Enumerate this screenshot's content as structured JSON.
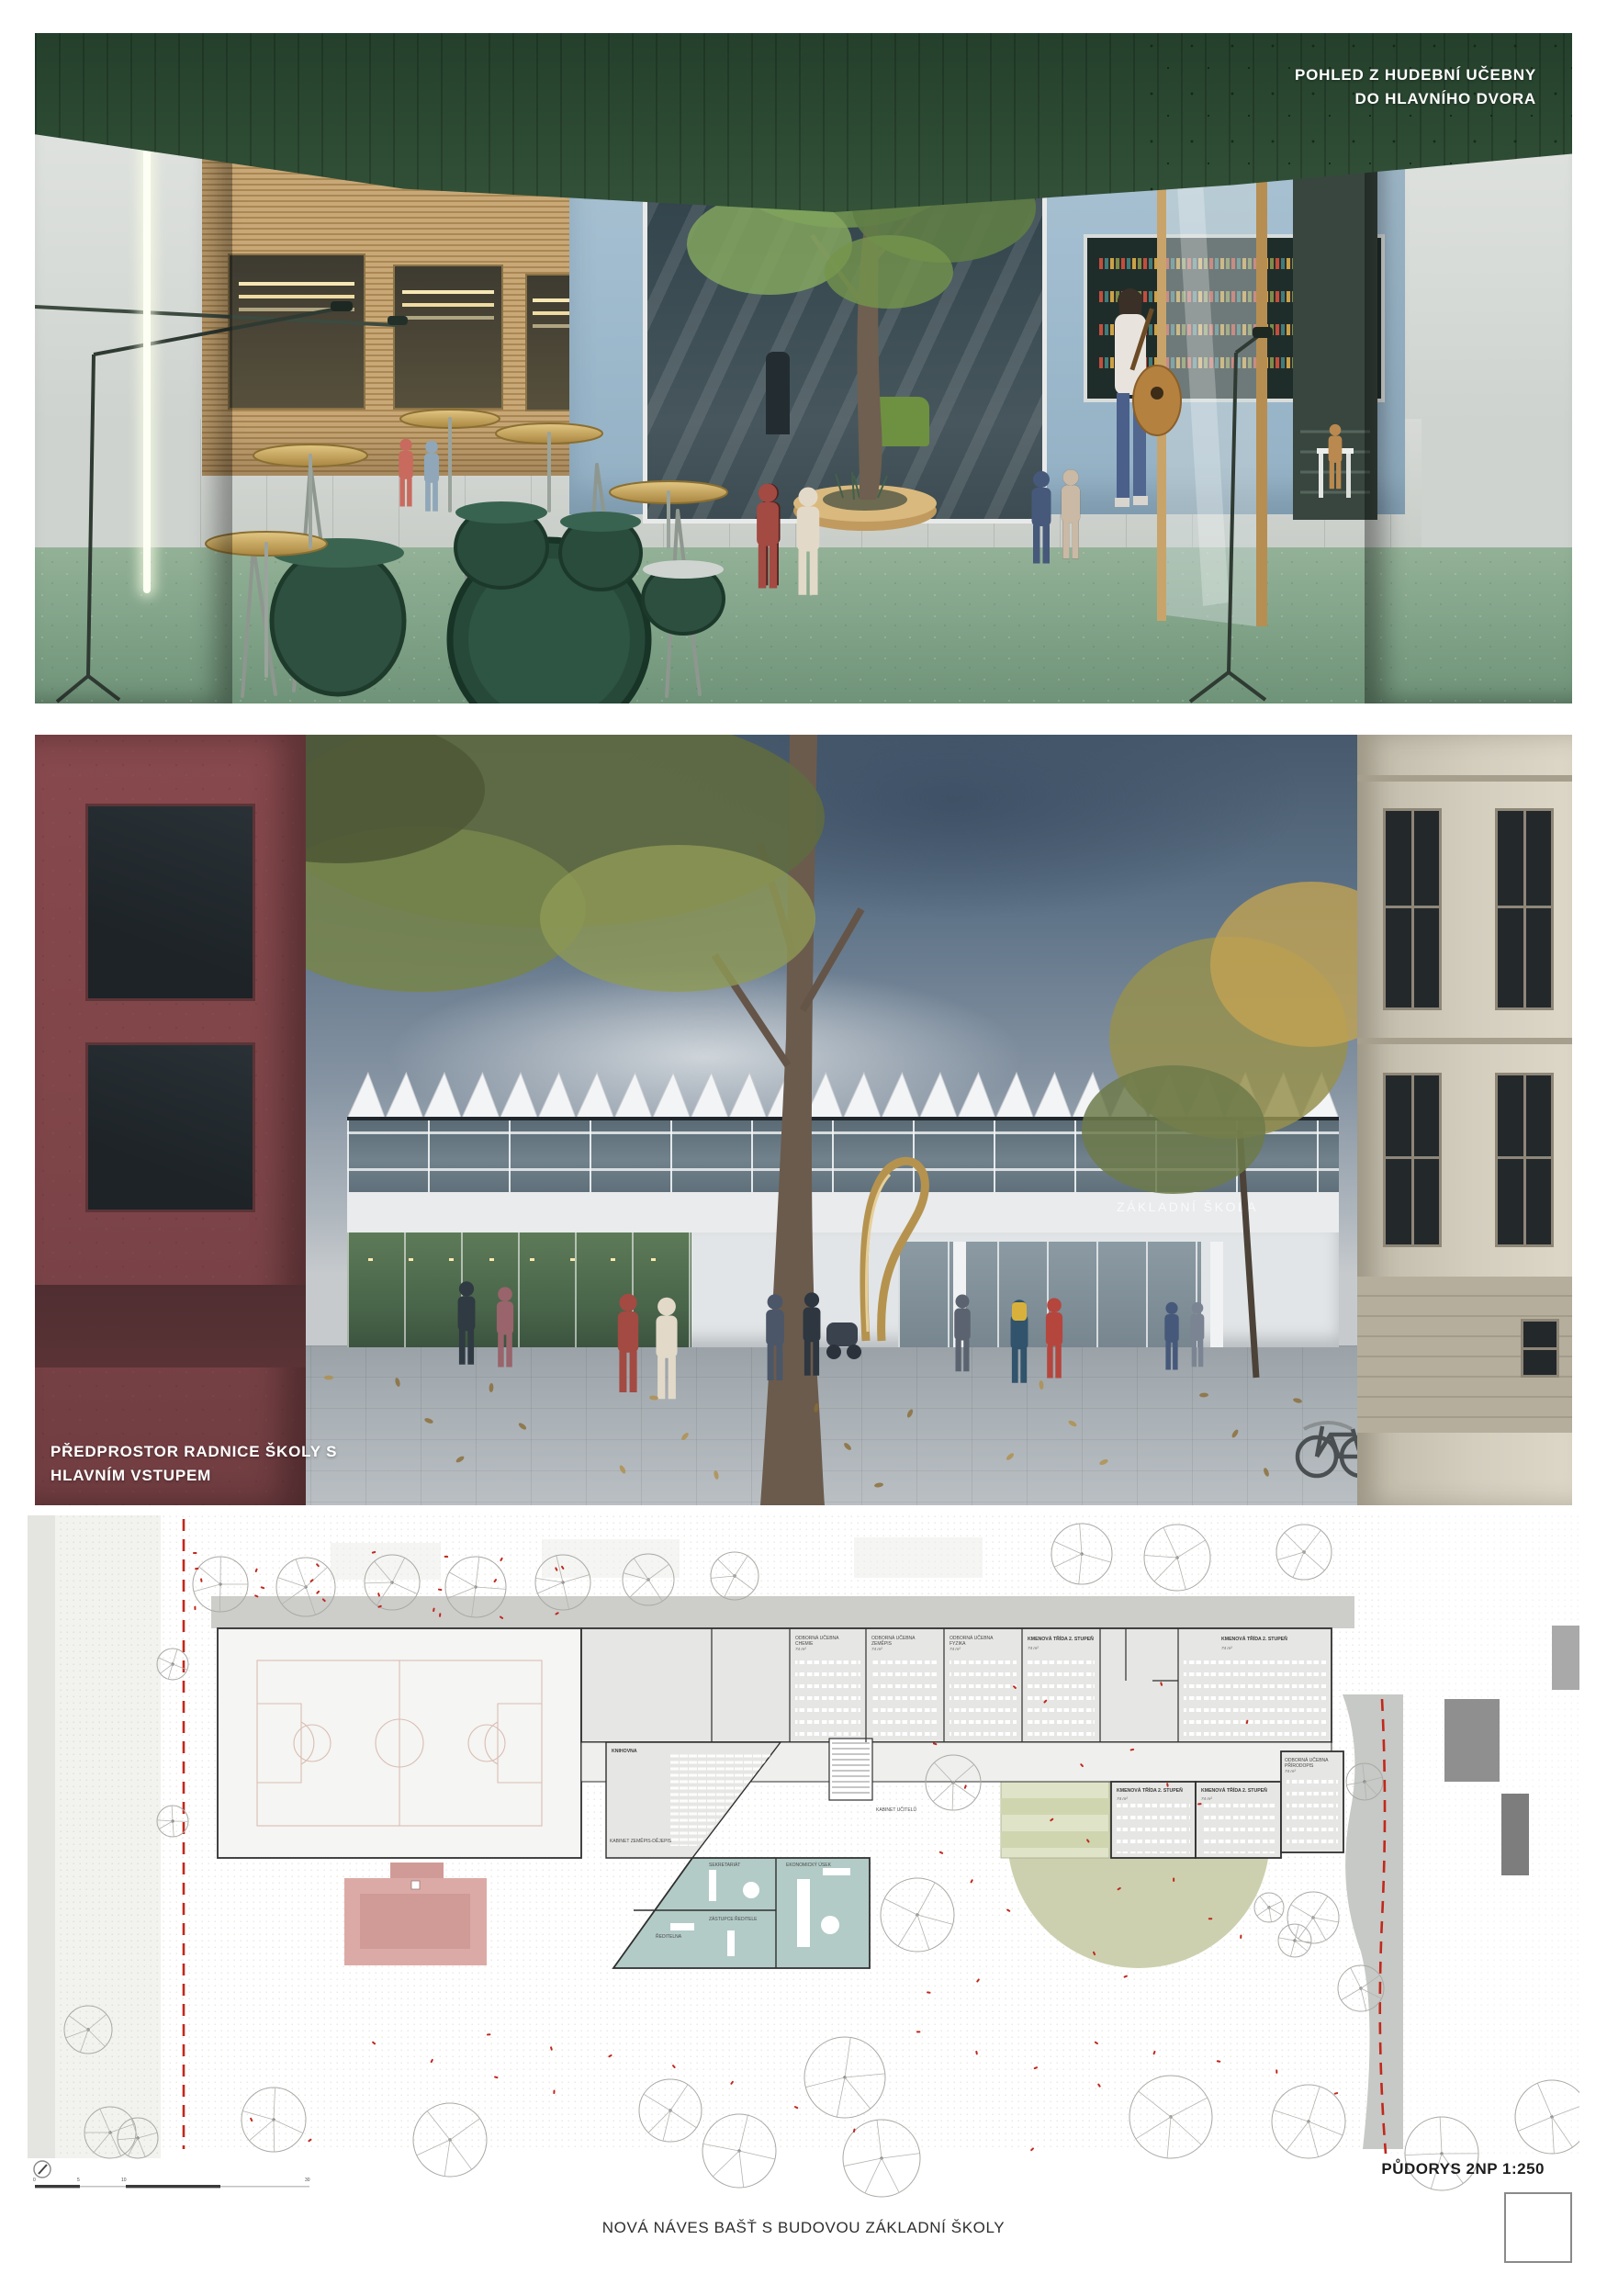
{
  "page": {
    "caption": "NOVÁ NÁVES BAŠŤ S BUDOVOU ZÁKLADNÍ ŠKOLY"
  },
  "panels": {
    "music_room_view": {
      "caption_line1": "POHLED Z HUDEBNÍ UČEBNY",
      "caption_line2": "DO HLAVNÍHO DVORA"
    },
    "square_view": {
      "caption_line1": "PŘEDPROSTOR RADNICE ŠKOLY S",
      "caption_line2": "HLAVNÍM VSTUPEM",
      "building_sign": "ZÁKLADNÍ ŠKOLA"
    }
  },
  "plan": {
    "title": "PŮDORYS 2NP 1:250",
    "scale": {
      "t0": "0",
      "t1": "5",
      "t2": "10",
      "t3": "30"
    },
    "rooms": [
      {
        "l1": "ODBORNÁ UČEBNA",
        "l2": "CHEMIE",
        "area": "74 m²"
      },
      {
        "l1": "ODBORNÁ UČEBNA",
        "l2": "ZEMĚPIS",
        "area": "74 m²"
      },
      {
        "l1": "ODBORNÁ UČEBNA",
        "l2": "FYZIKA",
        "area": "74 m²"
      },
      {
        "l1": "KMENOVÁ TŘÍDA 2. STUPEŇ",
        "area": "74 m²"
      },
      {
        "l1": "KMENOVÁ TŘÍDA 2. STUPEŇ",
        "area": "74 m²"
      },
      {
        "l1": "KMENOVÁ TŘÍDA 2. STUPEŇ",
        "area": "74 m²"
      },
      {
        "l1": "KMENOVÁ TŘÍDA 2. STUPEŇ",
        "area": "74 m²"
      },
      {
        "l1": "ODBORNÁ UČEBNA",
        "l2": "PŘÍRODOPIS",
        "area": "74 m²"
      }
    ],
    "offices": [
      {
        "l1": "KNIHOVNA"
      },
      {
        "l1": "KABINET ZEMĚPIS-DĚJEPIS"
      },
      {
        "l1": "KABINET UČITELŮ"
      },
      {
        "l1": "SEKRETARIÁT"
      },
      {
        "l1": "EKONOMICKÝ ÚSEK"
      },
      {
        "l1": "ZÁSTUPCE ŘEDITELE"
      },
      {
        "l1": "ŘEDITELNA"
      }
    ]
  },
  "colors": {
    "plan_red_dash": "#c3271b",
    "plan_teal": "#b2cbc7",
    "plan_olive": "#c9cdaa",
    "plan_pink": "#dcaaa6",
    "music_wall_green": "#4e7254",
    "sculpture_gold": "#c9a765",
    "school_sign_band": "#e9ebed"
  }
}
